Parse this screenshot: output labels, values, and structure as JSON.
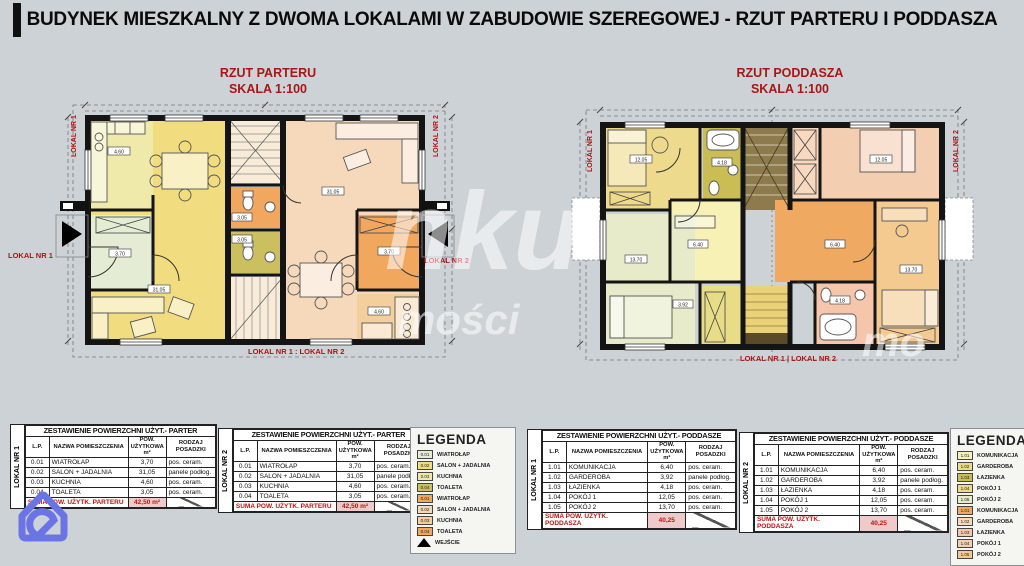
{
  "title": "BUDYNEK MIESZKALNY Z DWOMA LOKALAMI W ZABUDOWIE SZEREGOWEJ - RZUT PARTERU I PODDASZA",
  "plans": {
    "parter": {
      "caption1": "RZUT PARTERU",
      "caption2": "SKALA 1:100",
      "lokal1_vertical": "LOKAL NR 1",
      "lokal2_vertical": "LOKAL NR 2",
      "lokal1_label": "LOKAL NR 1",
      "lokal2_label": "LOKAL NR 2",
      "bottom_label": "LOKAL NR 1 : LOKAL NR 2",
      "tags": {
        "salon": "31.05",
        "kuchnia": "4.60",
        "wiatrolap": "3.70",
        "toaleta": "3.05"
      }
    },
    "poddasze": {
      "caption1": "RZUT PODDASZA",
      "caption2": "SKALA 1:100",
      "lokal1_vertical": "LOKAL NR 1",
      "lokal2_vertical": "LOKAL NR 2",
      "bottom_label": "LOKAL NR 1 | LOKAL NR 2",
      "tags": {
        "komunikacja": "6.40",
        "garderoba": "3.92",
        "lazienka": "4.18",
        "pokoj1": "12.05",
        "pokoj2": "13.70"
      }
    }
  },
  "tables": {
    "headers": [
      "L.P.",
      "NAZWA POMIESZCZENIA",
      "POW. UŻYTKOWA m²",
      "RODZAJ POSADZKI"
    ],
    "side_labels": [
      "LOKAL NR 1",
      "LOKAL NR 2"
    ],
    "parter": {
      "title": "ZESTAWIENIE POWIERZCHNI UŻYT.- PARTER",
      "rows": [
        [
          "0.01",
          "WIATROŁAP",
          "3,70",
          "pos. ceram."
        ],
        [
          "0.02",
          "SALON + JADALNIA",
          "31,05",
          "panele podłog."
        ],
        [
          "0.03",
          "KUCHNIA",
          "4,60",
          "pos. ceram."
        ],
        [
          "0.04",
          "TOALETA",
          "3,05",
          "pos. ceram."
        ]
      ],
      "sum_label": "SUMA POW. UŻYTK. PARTERU",
      "sum_value": "42,50 m²"
    },
    "poddasze": {
      "title": "ZESTAWIENIE POWIERZCHNI UŻYT.- PODDASZE",
      "rows": [
        [
          "1.01",
          "KOMUNIKACJA",
          "6,40",
          "pos. ceram."
        ],
        [
          "1.02",
          "GARDEROBA",
          "3,92",
          "panele podłog."
        ],
        [
          "1.03",
          "ŁAZIENKA",
          "4,18",
          "pos. ceram."
        ],
        [
          "1.04",
          "POKÓJ 1",
          "12,05",
          "pos. ceram."
        ],
        [
          "1.05",
          "POKÓJ 2",
          "13,70",
          "pos. ceram."
        ]
      ],
      "sum_label": "SUMA POW. UŻYTK. PODDASZA",
      "sum_value": "40,25"
    }
  },
  "legends": {
    "title": "LEGENDA",
    "parter": {
      "items": [
        {
          "code": "0.01",
          "label": "WIATROŁAP",
          "color": "#e4edd4"
        },
        {
          "code": "0.02",
          "label": "SALON + JADALNIA",
          "color": "#f1dd7f"
        },
        {
          "code": "0.03",
          "label": "KUCHNIA",
          "color": "#f0eaaa"
        },
        {
          "code": "0.04",
          "label": "TOALETA",
          "color": "#ccbf60"
        },
        {
          "code": "0.01",
          "label": "WIATROŁAP",
          "color": "#f2a75e"
        },
        {
          "code": "0.02",
          "label": "SALON + JADALNIA",
          "color": "#f6d9bb"
        },
        {
          "code": "0.03",
          "label": "KUCHNIA",
          "color": "#f3cf9d"
        },
        {
          "code": "0.04",
          "label": "TOALETA",
          "color": "#f2a75e"
        }
      ],
      "entrance_label": "WEJŚCIE"
    },
    "poddasze": {
      "items": [
        {
          "code": "1.01",
          "label": "KOMUNIKACJA",
          "color": "#f7f1b6"
        },
        {
          "code": "1.02",
          "label": "GARDEROBA",
          "color": "#e8dc86"
        },
        {
          "code": "1.03",
          "label": "ŁAZIENKA",
          "color": "#c9bd54"
        },
        {
          "code": "1.04",
          "label": "POKÓJ 1",
          "color": "#eeda8c"
        },
        {
          "code": "1.05",
          "label": "POKÓJ 2",
          "color": "#e7ebc9"
        },
        {
          "code": "1.01",
          "label": "KOMUNIKACJA",
          "color": "#f0a960"
        },
        {
          "code": "1.02",
          "label": "GARDEROBA",
          "color": "#f8d9c0"
        },
        {
          "code": "1.03",
          "label": "ŁAZIENKA",
          "color": "#f6c6ac"
        },
        {
          "code": "1.04",
          "label": "POKÓJ 1",
          "color": "#f3ceb1"
        },
        {
          "code": "1.05",
          "label": "POKÓJ 2",
          "color": "#f4ca90"
        }
      ]
    }
  },
  "watermark": {
    "fragments": [
      {
        "text": "nku",
        "x": 385,
        "y": 168,
        "size": 110
      },
      {
        "text": "mości",
        "x": 398,
        "y": 296,
        "size": 42
      },
      {
        "text": "mo",
        "x": 862,
        "y": 318,
        "size": 42
      }
    ]
  },
  "colors": {
    "background": "#cdd2d7",
    "accent_red": "#a81616",
    "wall": "#141414",
    "logo_blue": "#6a74e4"
  }
}
